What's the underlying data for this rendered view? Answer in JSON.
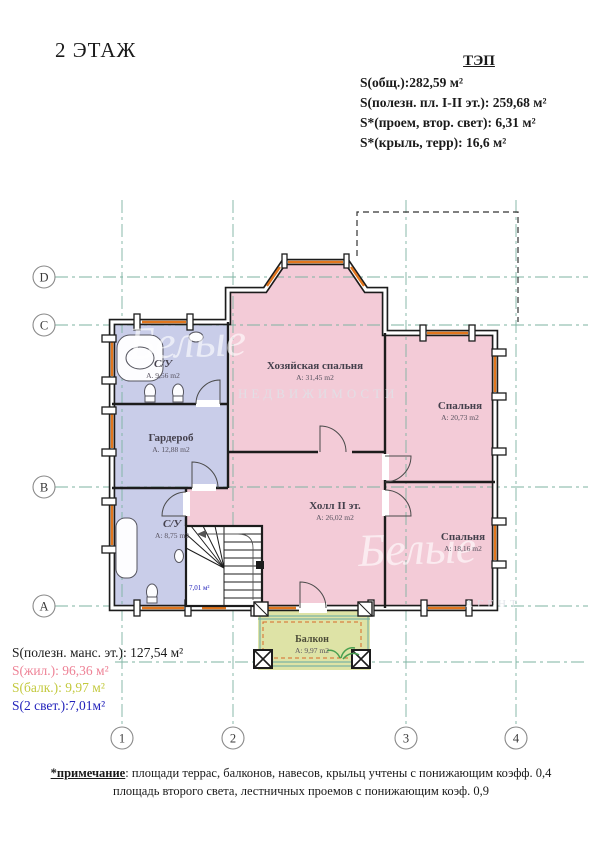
{
  "title": "2 ЭТАЖ",
  "tep": {
    "header": "ТЭП",
    "lines": [
      "S(общ.):282,59 м²",
      "S(полезн. пл. I-II эт.): 259,68 м²",
      "S*(проем, втор. свет): 6,31 м²",
      "S*(крыль, терр): 16,6 м²"
    ]
  },
  "axes": {
    "rows": [
      "D",
      "C",
      "B",
      "A"
    ],
    "cols": [
      "1",
      "2",
      "3",
      "4"
    ]
  },
  "rooms": [
    {
      "name": "С/У",
      "area": "А. 9,56 m2"
    },
    {
      "name": "Гардероб",
      "area": "А. 12,88 m2"
    },
    {
      "name": "С/У",
      "area": "А: 8,75 m2"
    },
    {
      "name": "Хозяйская спальня",
      "area": "А: 31,45 m2"
    },
    {
      "name": "Спальня",
      "area": "А: 20,73 m2"
    },
    {
      "name": "Холл II эт.",
      "area": "А: 26,02 m2"
    },
    {
      "name": "Спальня",
      "area": "А: 18,16 m2"
    },
    {
      "name": "Балкон",
      "area": "А: 9,97 m2"
    }
  ],
  "stair_area_label": "7,01 м²",
  "summary": [
    {
      "text": "S(полезн. манс. эт.): 127,54 м²",
      "color": "#1a1a1a"
    },
    {
      "text": "S(жил.): 96,36 м²",
      "color": "#ee8296"
    },
    {
      "text": "S(балк.): 9,97 м²",
      "color": "#c3c93e"
    },
    {
      "text": "S(2 свет.):7,01м²",
      "color": "#2222bb"
    }
  ],
  "note": {
    "label": "*примечание",
    "rest": ": площади террас, балконов, навесов, крыльц  учтены с понижающим коэфф. 0,4",
    "line2": "площадь второго света, лестничных проемов с понижающим коэф. 0,9"
  },
  "watermark": {
    "script": "Белые",
    "caps": "НЕДВИЖИМОСТИ",
    "caps2": "АГЕНТ"
  },
  "colors": {
    "wall": "#1c1c1c",
    "window_accent": "#e2761d",
    "axis_line": "#7db3a2",
    "room_pink": "#f3cbd7",
    "room_lavender": "#c9cde9",
    "balcony_fill": "#dee3a6",
    "stair_label_blue": "#2323bb"
  }
}
